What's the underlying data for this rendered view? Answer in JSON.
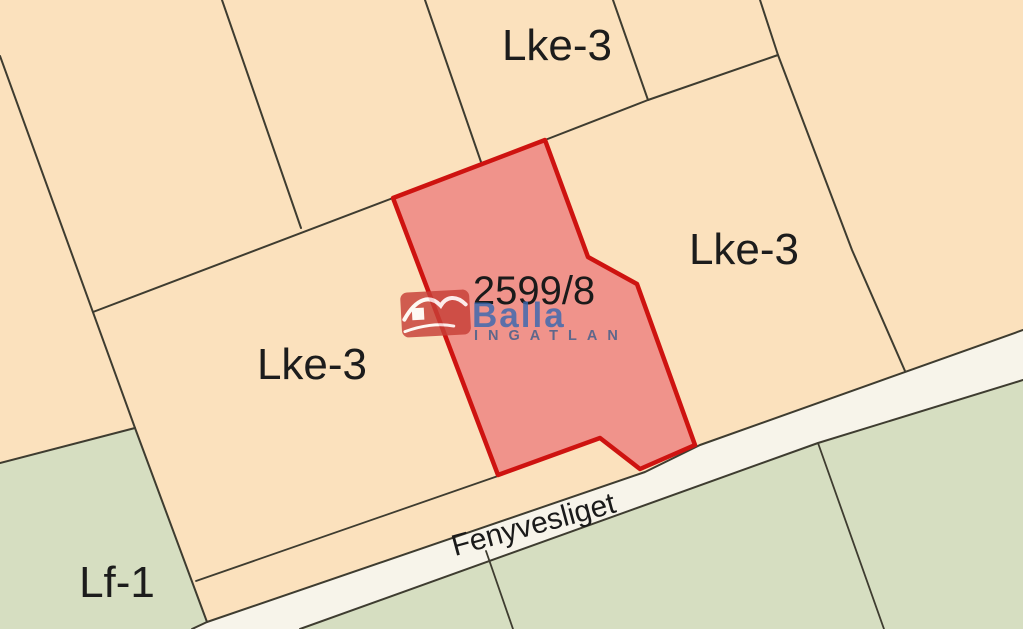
{
  "map": {
    "labels": {
      "zone_top": "Lke-3",
      "zone_right": "Lke-3",
      "zone_left": "Lke-3",
      "zone_bottom_left": "Lf-1",
      "parcel_number": "2599/8",
      "street": "Fenyvesliget"
    },
    "watermark": {
      "brand": "Balla",
      "sub": "INGATLAN"
    },
    "colors": {
      "parcel_fill": "#fbe1bd",
      "green_fill": "#d6dec1",
      "road_fill": "#f7f4ea",
      "boundary_line": "#3e3c30",
      "highlight_fill": "#f0938b",
      "highlight_border": "#ce1310",
      "brand_red": "#c74038",
      "brand_blue": "#3a69b0",
      "brand_navy": "#3f5e8c",
      "label_color": "#1c1c1c"
    }
  }
}
